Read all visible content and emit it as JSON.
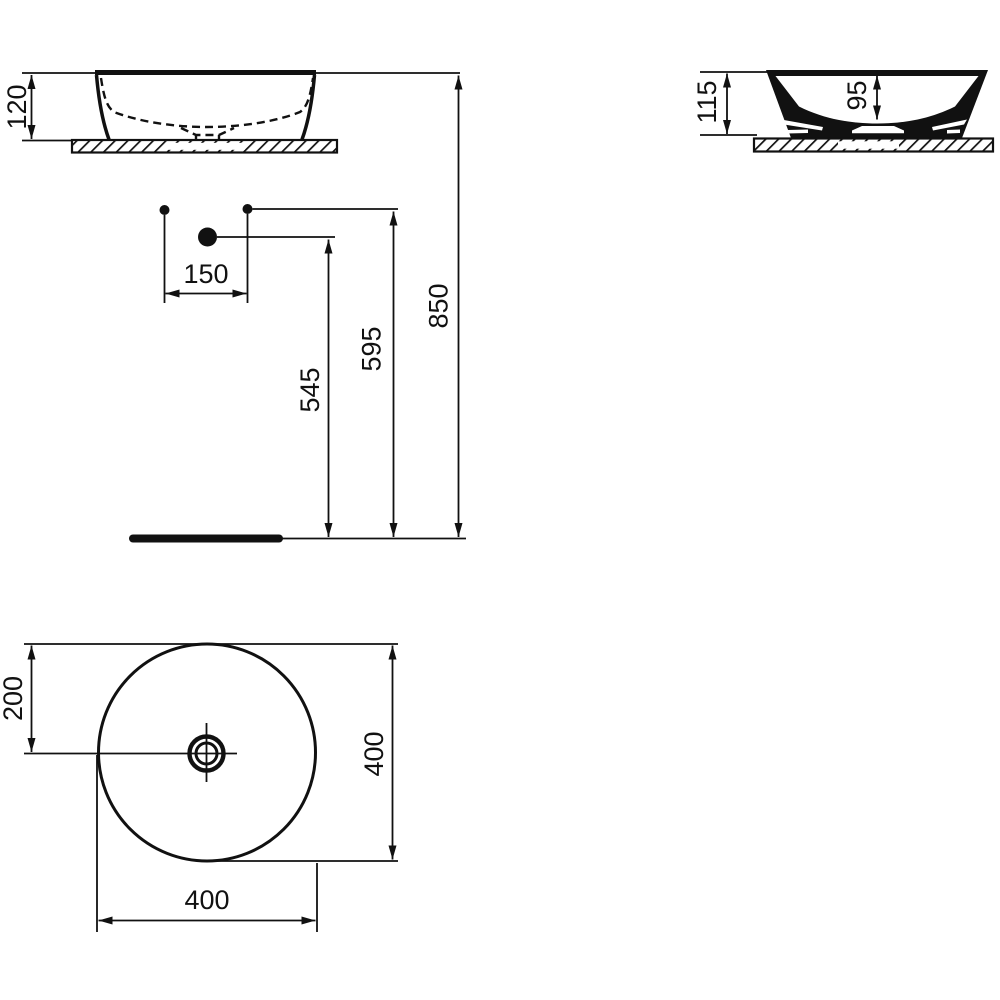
{
  "palette": {
    "ink": "#111111",
    "paper": "#ffffff"
  },
  "views": {
    "front_elevation": {
      "basin_height": "120"
    },
    "side_section": {
      "overall_height": "115",
      "bowl_depth": "95"
    },
    "installation": {
      "spout_offset": "150",
      "trap_height": "545",
      "supply_height": "595",
      "rim_height": "850"
    },
    "plan": {
      "centre_offset": "200",
      "overall_depth": "400",
      "overall_width": "400"
    }
  }
}
